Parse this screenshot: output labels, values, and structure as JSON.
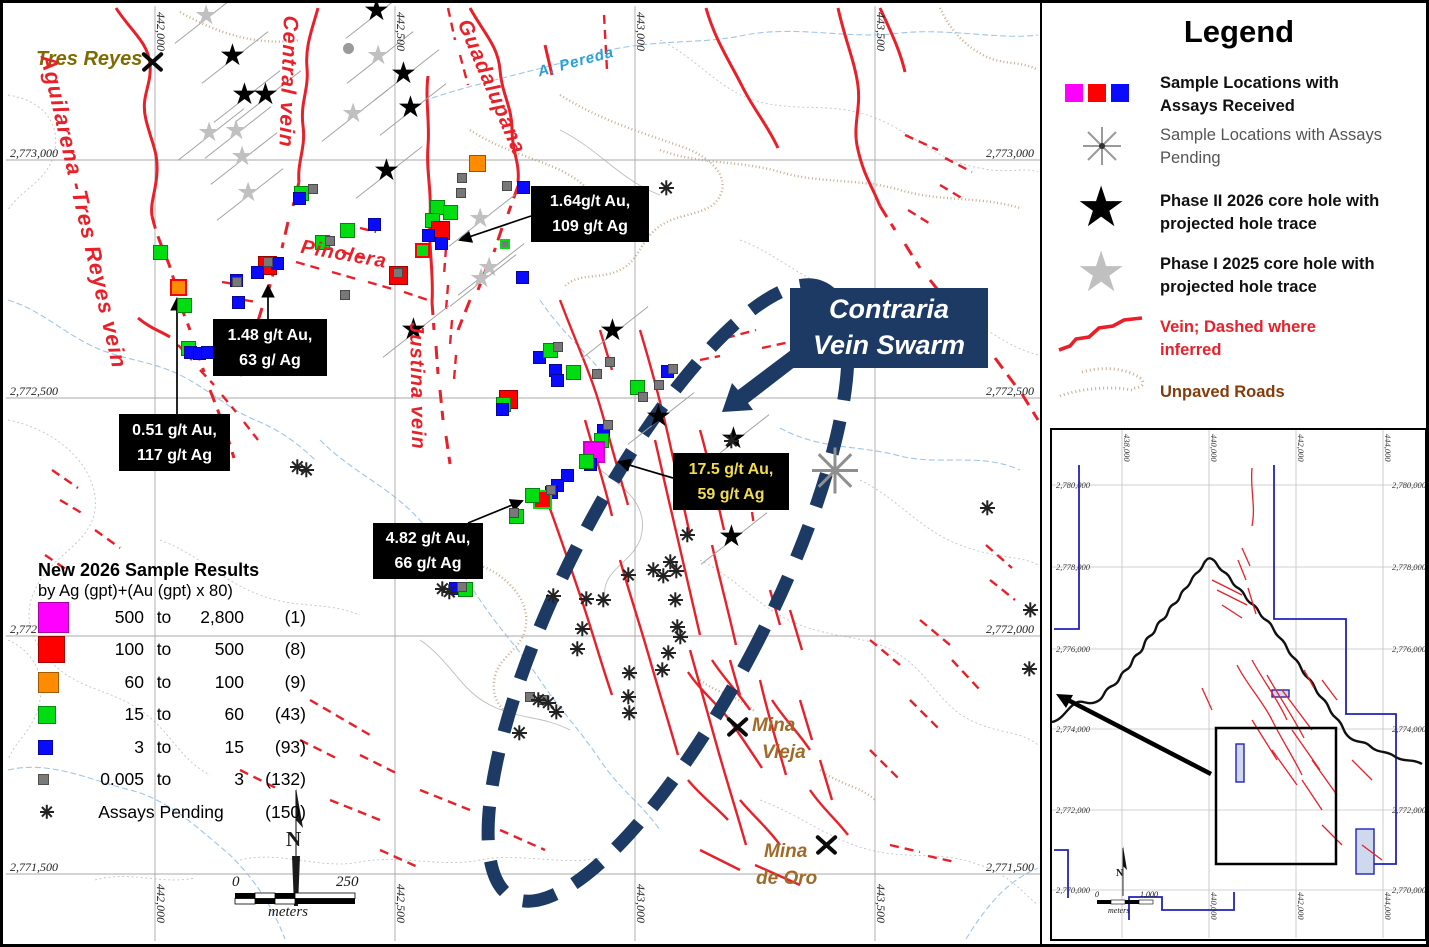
{
  "colors": {
    "vein_red": "#e8202a",
    "navy": "#1c3a64",
    "magenta": "#ff00ff",
    "red": "#ff0000",
    "orange": "#ff8b00",
    "green": "#00dd11",
    "blue": "#0a0aff",
    "gray": "#787878",
    "star_gray": "#c0c0c0",
    "road_tan": "#c9ae8e",
    "stream_blue": "#9fc5e8",
    "olive": "#7f6b00",
    "mine_brown": "#a06a28",
    "legend_brown": "#843c0c",
    "pending_text_gray": "#555555",
    "annotation_yellow": "#f2dc4e"
  },
  "map": {
    "grid": {
      "x": [
        {
          "label": "442,000",
          "x": 155
        },
        {
          "label": "442,500",
          "x": 395
        },
        {
          "label": "443,000",
          "x": 635
        },
        {
          "label": "443,500",
          "x": 875
        }
      ],
      "y": [
        {
          "y": 160,
          "left": "2,773,000",
          "right": "2,773,000"
        },
        {
          "y": 398,
          "left": "2,772,500",
          "right": "2,772,500"
        },
        {
          "y": 636,
          "left": "2,772",
          "right": "2,772,000"
        },
        {
          "y": 874,
          "left": "2,771,500",
          "right": "2,771,500"
        }
      ]
    },
    "labels": {
      "tres_reyes": "Tres Reyes",
      "mina_vieja_1": "Mina",
      "mina_vieja_2": "Vieja",
      "mina_de_oro_1": "Mina",
      "mina_de_oro_2": "de Oro"
    },
    "vein_labels": [
      {
        "text": "Aguilarena -Tres Reyes  vein",
        "x": 60,
        "y": 52,
        "rot": 77,
        "size": 22
      },
      {
        "text": "Central  vein",
        "x": 302,
        "y": 16,
        "rot": 92,
        "size": 21
      },
      {
        "text": "Guadalupana",
        "x": 474,
        "y": 16,
        "rot": 67,
        "size": 21
      },
      {
        "text": "Pinolera",
        "x": 303,
        "y": 236,
        "rot": 10,
        "size": 20
      },
      {
        "text": "Justina  vein",
        "x": 427,
        "y": 322,
        "rot": 89,
        "size": 20
      },
      {
        "text": "A. Pereda",
        "x": 536,
        "y": 64,
        "rot": -15,
        "size": 15,
        "color": "#2b9fd8",
        "weight": "600"
      }
    ],
    "callout": {
      "line1": "Contraria",
      "line2": "Vein Swarm"
    },
    "annotations": [
      {
        "line1": "1.64g/t Au,",
        "line2": "109 g/t Ag",
        "x": 531,
        "y": 186,
        "w": 118,
        "h": 56,
        "color": "#ffffff",
        "ax1": 531,
        "ay1": 216,
        "ax2": 460,
        "ay2": 240
      },
      {
        "line1": "1.48 g/t Au,",
        "line2": "63 g/ Ag",
        "x": 213,
        "y": 319,
        "w": 114,
        "h": 57,
        "color": "#ffffff",
        "ax1": 268,
        "ay1": 319,
        "ax2": 268,
        "ay2": 286
      },
      {
        "line1": "0.51 g/t Au,",
        "line2": "117 g/t Ag",
        "x": 119,
        "y": 414,
        "w": 111,
        "h": 57,
        "color": "#ffffff",
        "ax1": 177,
        "ay1": 414,
        "ax2": 177,
        "ay2": 299
      },
      {
        "line1": "17.5 g/t Au,",
        "line2": "59 g/t Ag",
        "x": 673,
        "y": 453,
        "w": 116,
        "h": 57,
        "color": "#f2dc4e",
        "ax1": 673,
        "ay1": 478,
        "ax2": 619,
        "ay2": 462
      },
      {
        "line1": "4.82 g/t Au,",
        "line2": "66 g/t Ag",
        "x": 373,
        "y": 523,
        "w": 110,
        "h": 56,
        "color": "#ffffff",
        "ax1": 468,
        "ay1": 523,
        "ax2": 522,
        "ay2": 501
      }
    ],
    "markers": {
      "squares": [
        [
          "o",
          178,
          287,
          "#ff0000"
        ],
        [
          "g",
          160,
          252
        ],
        [
          "g",
          184,
          305
        ],
        [
          "g",
          188,
          348
        ],
        [
          "b",
          190,
          352
        ],
        [
          "b",
          199,
          353
        ],
        [
          "b",
          207,
          352
        ],
        [
          "k",
          243,
          357
        ],
        [
          "r",
          267,
          265
        ],
        [
          "b",
          277,
          263
        ],
        [
          "b",
          257,
          272
        ],
        [
          "k",
          268,
          262
        ],
        [
          "b",
          236,
          280
        ],
        [
          "b",
          238,
          302
        ],
        [
          "k",
          237,
          282
        ],
        [
          "g",
          301,
          193
        ],
        [
          "b",
          299,
          198
        ],
        [
          "k",
          313,
          189
        ],
        [
          "k",
          345,
          295
        ],
        [
          "b",
          374,
          224
        ],
        [
          "g",
          347,
          230
        ],
        [
          "g",
          322,
          242
        ],
        [
          "k",
          330,
          241
        ],
        [
          "r",
          398,
          275
        ],
        [
          "k",
          398,
          273
        ],
        [
          "g",
          437,
          207
        ],
        [
          "g",
          450,
          212
        ],
        [
          "g",
          432,
          220
        ],
        [
          "r",
          440,
          230
        ],
        [
          "b",
          428,
          235
        ],
        [
          "b",
          441,
          243
        ],
        [
          "g",
          422,
          250,
          "#ff0000"
        ],
        [
          "k",
          462,
          178
        ],
        [
          "k",
          461,
          193
        ],
        [
          "o",
          477,
          163
        ],
        [
          "k",
          507,
          186
        ],
        [
          "b",
          523,
          187
        ],
        [
          "k",
          505,
          244,
          "#00dd11"
        ],
        [
          "b",
          522,
          277
        ],
        [
          "b",
          539,
          357
        ],
        [
          "g",
          550,
          350
        ],
        [
          "k",
          558,
          347
        ],
        [
          "b",
          555,
          370
        ],
        [
          "g",
          573,
          372
        ],
        [
          "b",
          557,
          380
        ],
        [
          "k",
          610,
          362
        ],
        [
          "k",
          597,
          374
        ],
        [
          "b",
          667,
          371
        ],
        [
          "k",
          673,
          369
        ],
        [
          "g",
          637,
          387
        ],
        [
          "k",
          659,
          385
        ],
        [
          "k",
          643,
          397
        ],
        [
          "r",
          508,
          399
        ],
        [
          "g",
          503,
          404
        ],
        [
          "b",
          502,
          409
        ],
        [
          "b",
          603,
          430
        ],
        [
          "k",
          608,
          425
        ],
        [
          "g",
          601,
          440
        ],
        [
          "m",
          594,
          452,
          "#cc00cc"
        ],
        [
          "b",
          590,
          464
        ],
        [
          "g",
          586,
          461
        ],
        [
          "b",
          567,
          475
        ],
        [
          "b",
          557,
          485
        ],
        [
          "b",
          551,
          492
        ],
        [
          "r",
          542,
          499,
          "#00dd11"
        ],
        [
          "g",
          532,
          495
        ],
        [
          "k",
          551,
          490
        ],
        [
          "g",
          516,
          516
        ],
        [
          "k",
          514,
          513
        ],
        [
          "b",
          455,
          588
        ],
        [
          "g",
          465,
          589
        ],
        [
          "k",
          462,
          587
        ],
        [
          "k",
          530,
          697
        ],
        [
          "k",
          543,
          700
        ]
      ],
      "stars_black": [
        [
          235,
          57
        ],
        [
          247,
          96
        ],
        [
          268,
          96
        ],
        [
          379,
          12
        ],
        [
          406,
          75
        ],
        [
          413,
          109
        ],
        [
          389,
          172
        ],
        [
          416,
          331
        ],
        [
          615,
          332
        ],
        [
          661,
          418
        ],
        [
          736,
          440
        ],
        [
          734,
          538
        ]
      ],
      "stars_gray": [
        [
          208,
          17
        ],
        [
          380,
          57
        ],
        [
          355,
          115
        ],
        [
          238,
          132
        ],
        [
          211,
          134
        ],
        [
          244,
          158
        ],
        [
          250,
          194
        ],
        [
          482,
          220
        ],
        [
          491,
          269
        ],
        [
          483,
          280
        ]
      ],
      "circles": [
        [
          348,
          48
        ]
      ],
      "picks": [
        [
          152,
          62
        ],
        [
          737,
          727
        ],
        [
          826,
          845
        ]
      ],
      "asterisks": [
        [
          297,
          467
        ],
        [
          306,
          470
        ],
        [
          666,
          188
        ],
        [
          731,
          441
        ],
        [
          687,
          535
        ],
        [
          670,
          562
        ],
        [
          676,
          571
        ],
        [
          663,
          576
        ],
        [
          442,
          589
        ],
        [
          449,
          592
        ],
        [
          603,
          600
        ],
        [
          628,
          575
        ],
        [
          653,
          570
        ],
        [
          675,
          600
        ],
        [
          677,
          627
        ],
        [
          680,
          637
        ],
        [
          668,
          653
        ],
        [
          662,
          670
        ],
        [
          629,
          673
        ],
        [
          628,
          697
        ],
        [
          629,
          713
        ],
        [
          538,
          700
        ],
        [
          548,
          703
        ],
        [
          556,
          712
        ],
        [
          519,
          733
        ],
        [
          577,
          649
        ],
        [
          582,
          629
        ],
        [
          553,
          596
        ],
        [
          586,
          599
        ],
        [
          987,
          508
        ],
        [
          1030,
          610
        ],
        [
          1029,
          669
        ]
      ],
      "big_asterisks": [
        [
          835,
          470
        ]
      ]
    },
    "scale": {
      "zero": "0",
      "max": "250",
      "unit": "meters",
      "north": "N"
    }
  },
  "results": {
    "title": "New 2026 Sample Results",
    "subtitle": "by Ag (gpt)+(Au (gpt) x 80)",
    "to_word": "to",
    "rows": [
      {
        "color": "#ff00ff",
        "size": 31,
        "lo": "500",
        "hi": "2,800",
        "n": "(1)"
      },
      {
        "color": "#ff0000",
        "size": 27,
        "lo": "100",
        "hi": "500",
        "n": "(8)"
      },
      {
        "color": "#ff8b00",
        "size": 21,
        "lo": "60",
        "hi": "100",
        "n": "(9)"
      },
      {
        "color": "#00dd11",
        "size": 18,
        "lo": "15",
        "hi": "60",
        "n": "(43)"
      },
      {
        "color": "#0a0aff",
        "size": 15,
        "lo": "3",
        "hi": "15",
        "n": "(93)"
      },
      {
        "color": "#7a7a7a",
        "size": 11,
        "lo": "0.005",
        "hi": "3",
        "n": "(132)"
      }
    ],
    "pending": {
      "label": "Assays Pending",
      "n": "(150)"
    }
  },
  "legend": {
    "title": "Legend",
    "items": [
      {
        "l1": "Sample Locations with",
        "l2": "Assays Received"
      },
      {
        "l1": "Sample Locations with Assays",
        "l2": "Pending"
      },
      {
        "l1": "Phase II 2026 core hole with",
        "l2": "projected hole trace"
      },
      {
        "l1": "Phase I 2025 core hole with",
        "l2": "projected hole trace"
      },
      {
        "l1": "Vein; Dashed where",
        "l2": "inferred"
      },
      {
        "l1": "Unpaved Roads",
        "l2": ""
      }
    ]
  },
  "inset": {
    "top_labels": [
      {
        "t": "438,000",
        "x": 70
      },
      {
        "t": "440,000",
        "x": 157
      },
      {
        "t": "442,000",
        "x": 244
      },
      {
        "t": "444,000",
        "x": 331
      }
    ],
    "bottom_labels": [
      {
        "t": "440,000",
        "x": 157
      },
      {
        "t": "442,000",
        "x": 244
      },
      {
        "t": "444,000",
        "x": 331
      }
    ],
    "left_labels": [
      {
        "t": "2,780,000",
        "y": 55
      },
      {
        "t": "2,778,000",
        "y": 137
      },
      {
        "t": "2,776,000",
        "y": 219
      },
      {
        "t": "2,774,000",
        "y": 299
      },
      {
        "t": "2,772,000",
        "y": 380
      },
      {
        "t": "2,770,000",
        "y": 460
      }
    ],
    "right_labels": [
      {
        "t": "2,780,000",
        "y": 55
      },
      {
        "t": "2,778,000",
        "y": 137
      },
      {
        "t": "2,776,000",
        "y": 219
      },
      {
        "t": "2,774,000",
        "y": 299
      },
      {
        "t": "2,772,000",
        "y": 380
      },
      {
        "t": "2,770,000",
        "y": 460
      }
    ],
    "scale": {
      "zero": "0",
      "max": "1,000",
      "unit": "meters",
      "north": "N"
    }
  }
}
